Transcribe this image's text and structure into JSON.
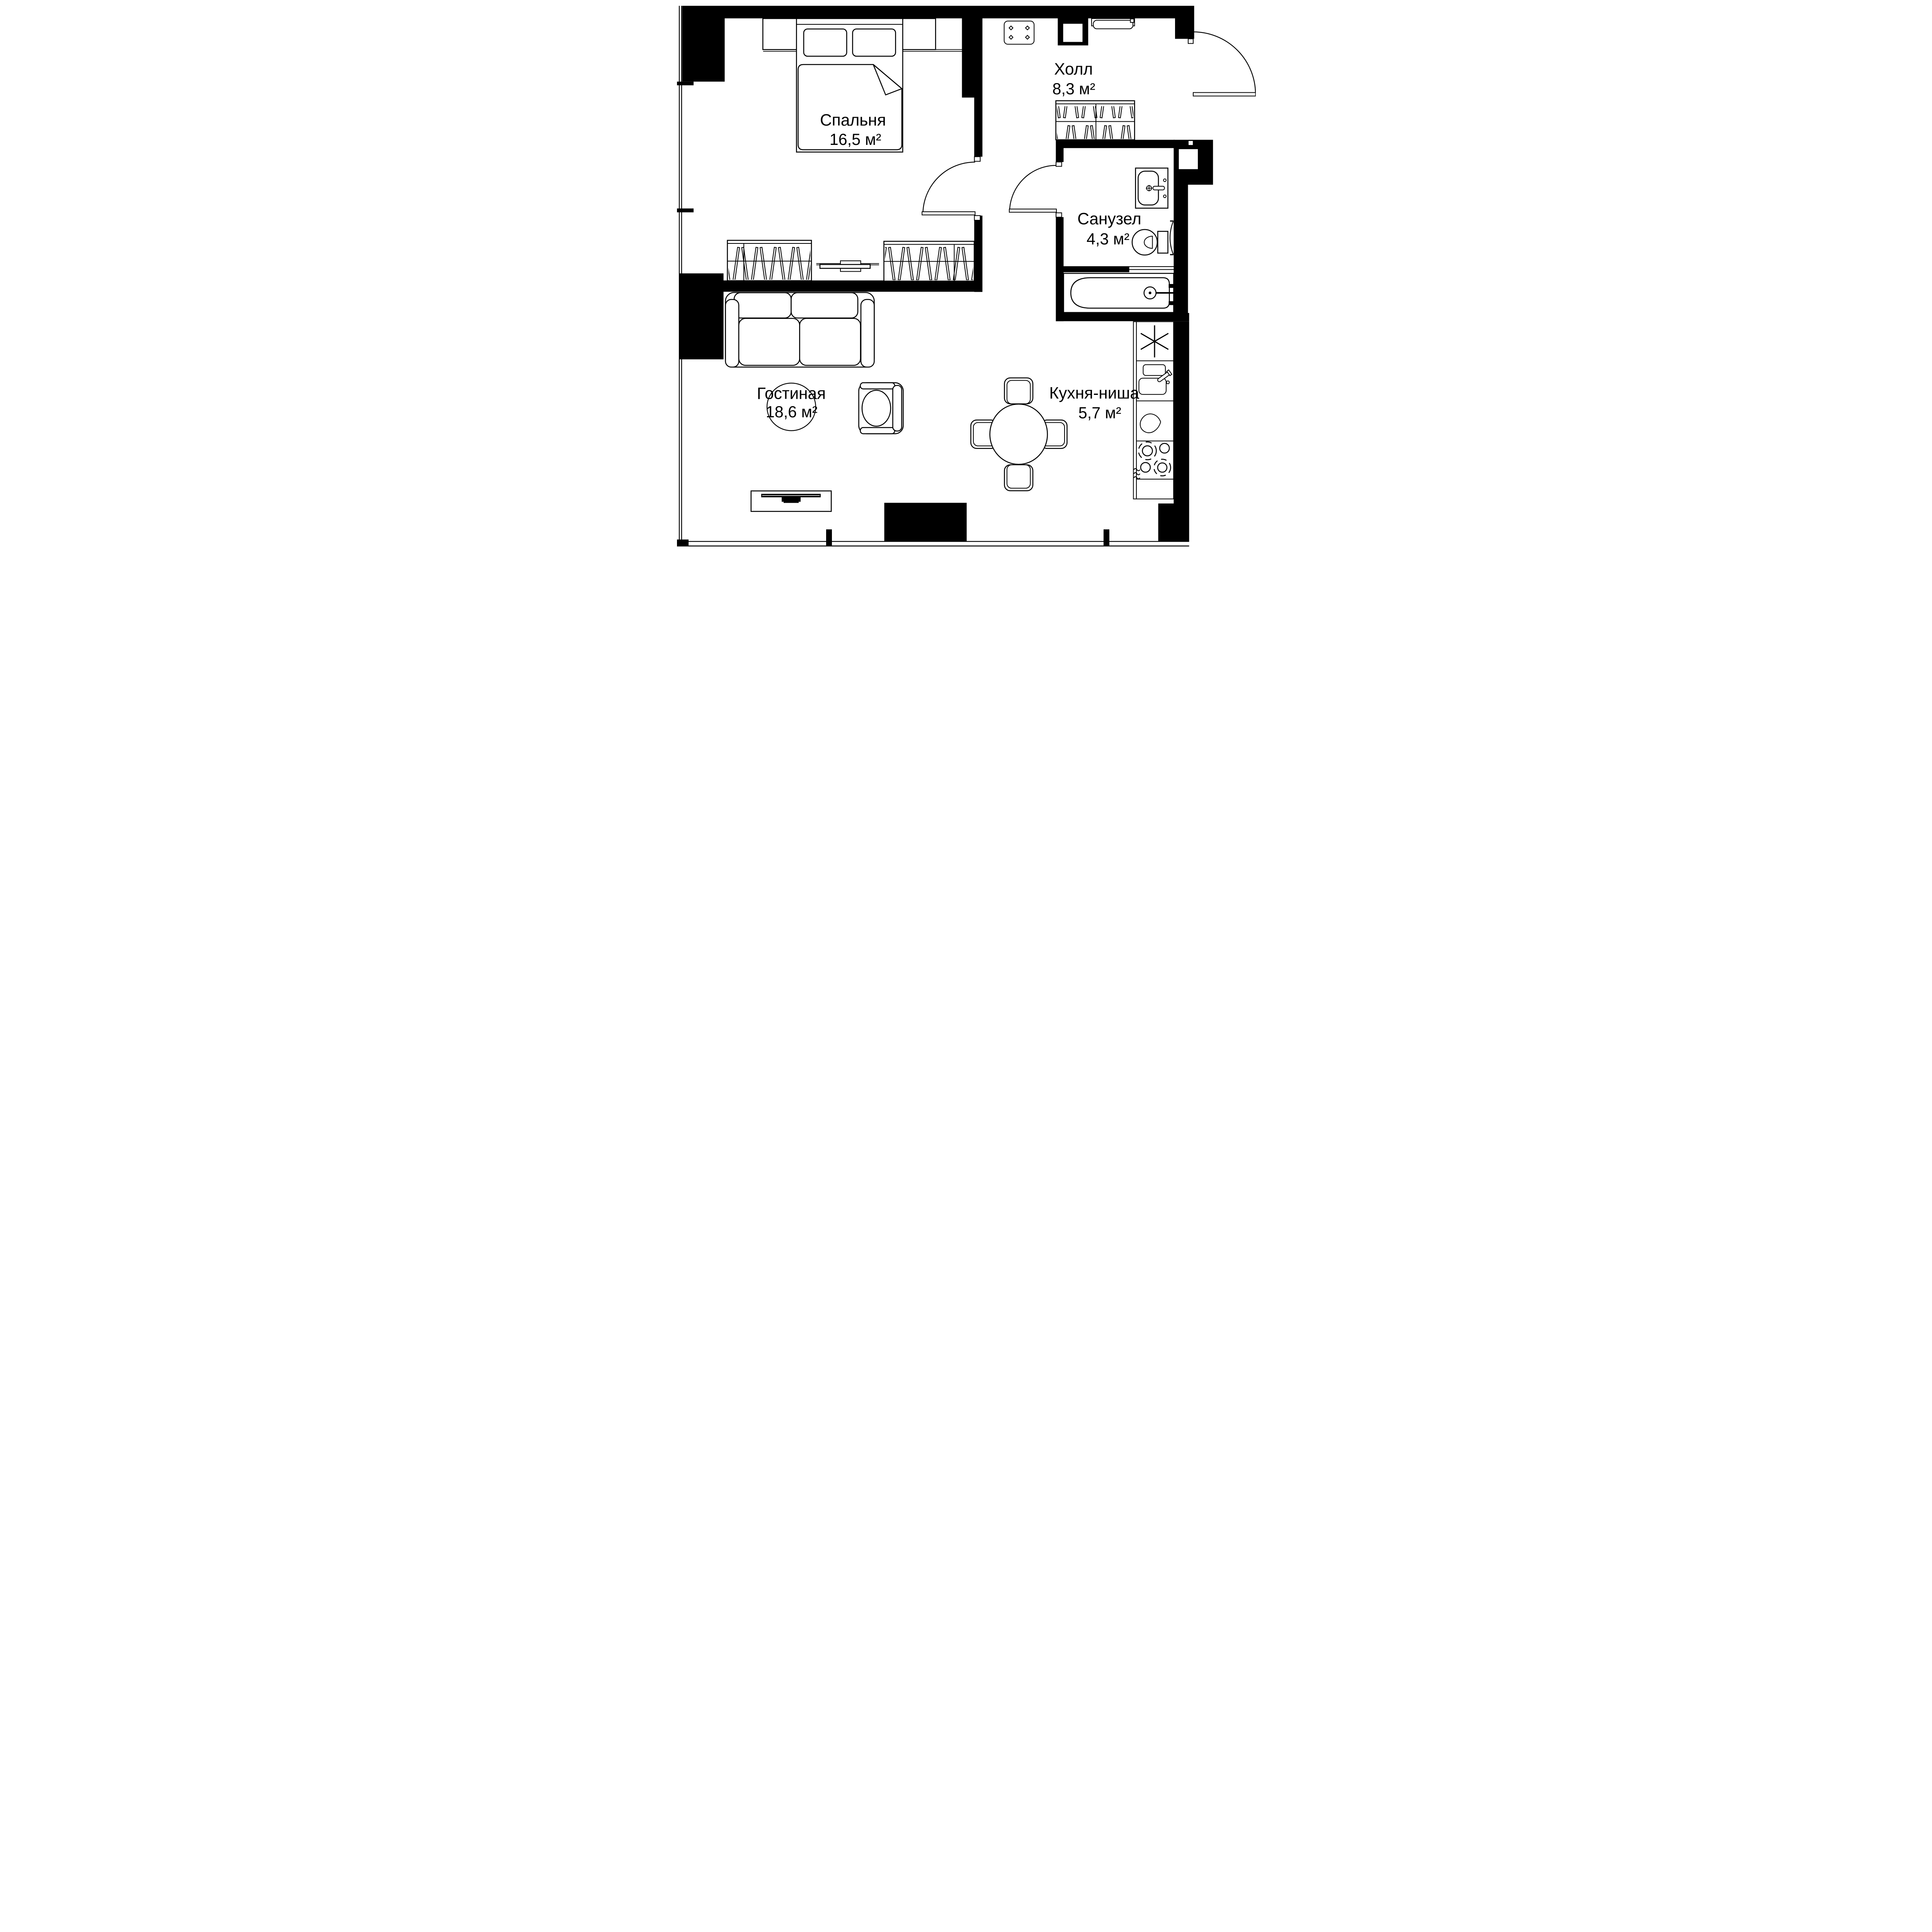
{
  "plan": {
    "type": "apartment-floor-plan",
    "units": "м²",
    "colors": {
      "walls": "#000000",
      "background": "#ffffff",
      "lines": "#000000"
    }
  },
  "rooms": [
    {
      "name": "Спальня",
      "area": "16,5 м²"
    },
    {
      "name": "Холл",
      "area": "8,3 м²"
    },
    {
      "name": "Санузел",
      "area": "4,3 м²"
    },
    {
      "name": "Гостиная",
      "area": "18,6 м²"
    },
    {
      "name": "Кухня-ниша",
      "area": "5,7 м²"
    }
  ],
  "icons": {
    "fridge": "six-spoke-asterisk",
    "kitchen_sink": "double-bowl-with-faucet",
    "appliance": "water-drop",
    "stove": "four-burners-two-dashed",
    "extract": "wavy-steam-lines",
    "wardrobe_fill": "slanted-hanger-hatch",
    "doors": "quarter-circle-swing-arc"
  }
}
